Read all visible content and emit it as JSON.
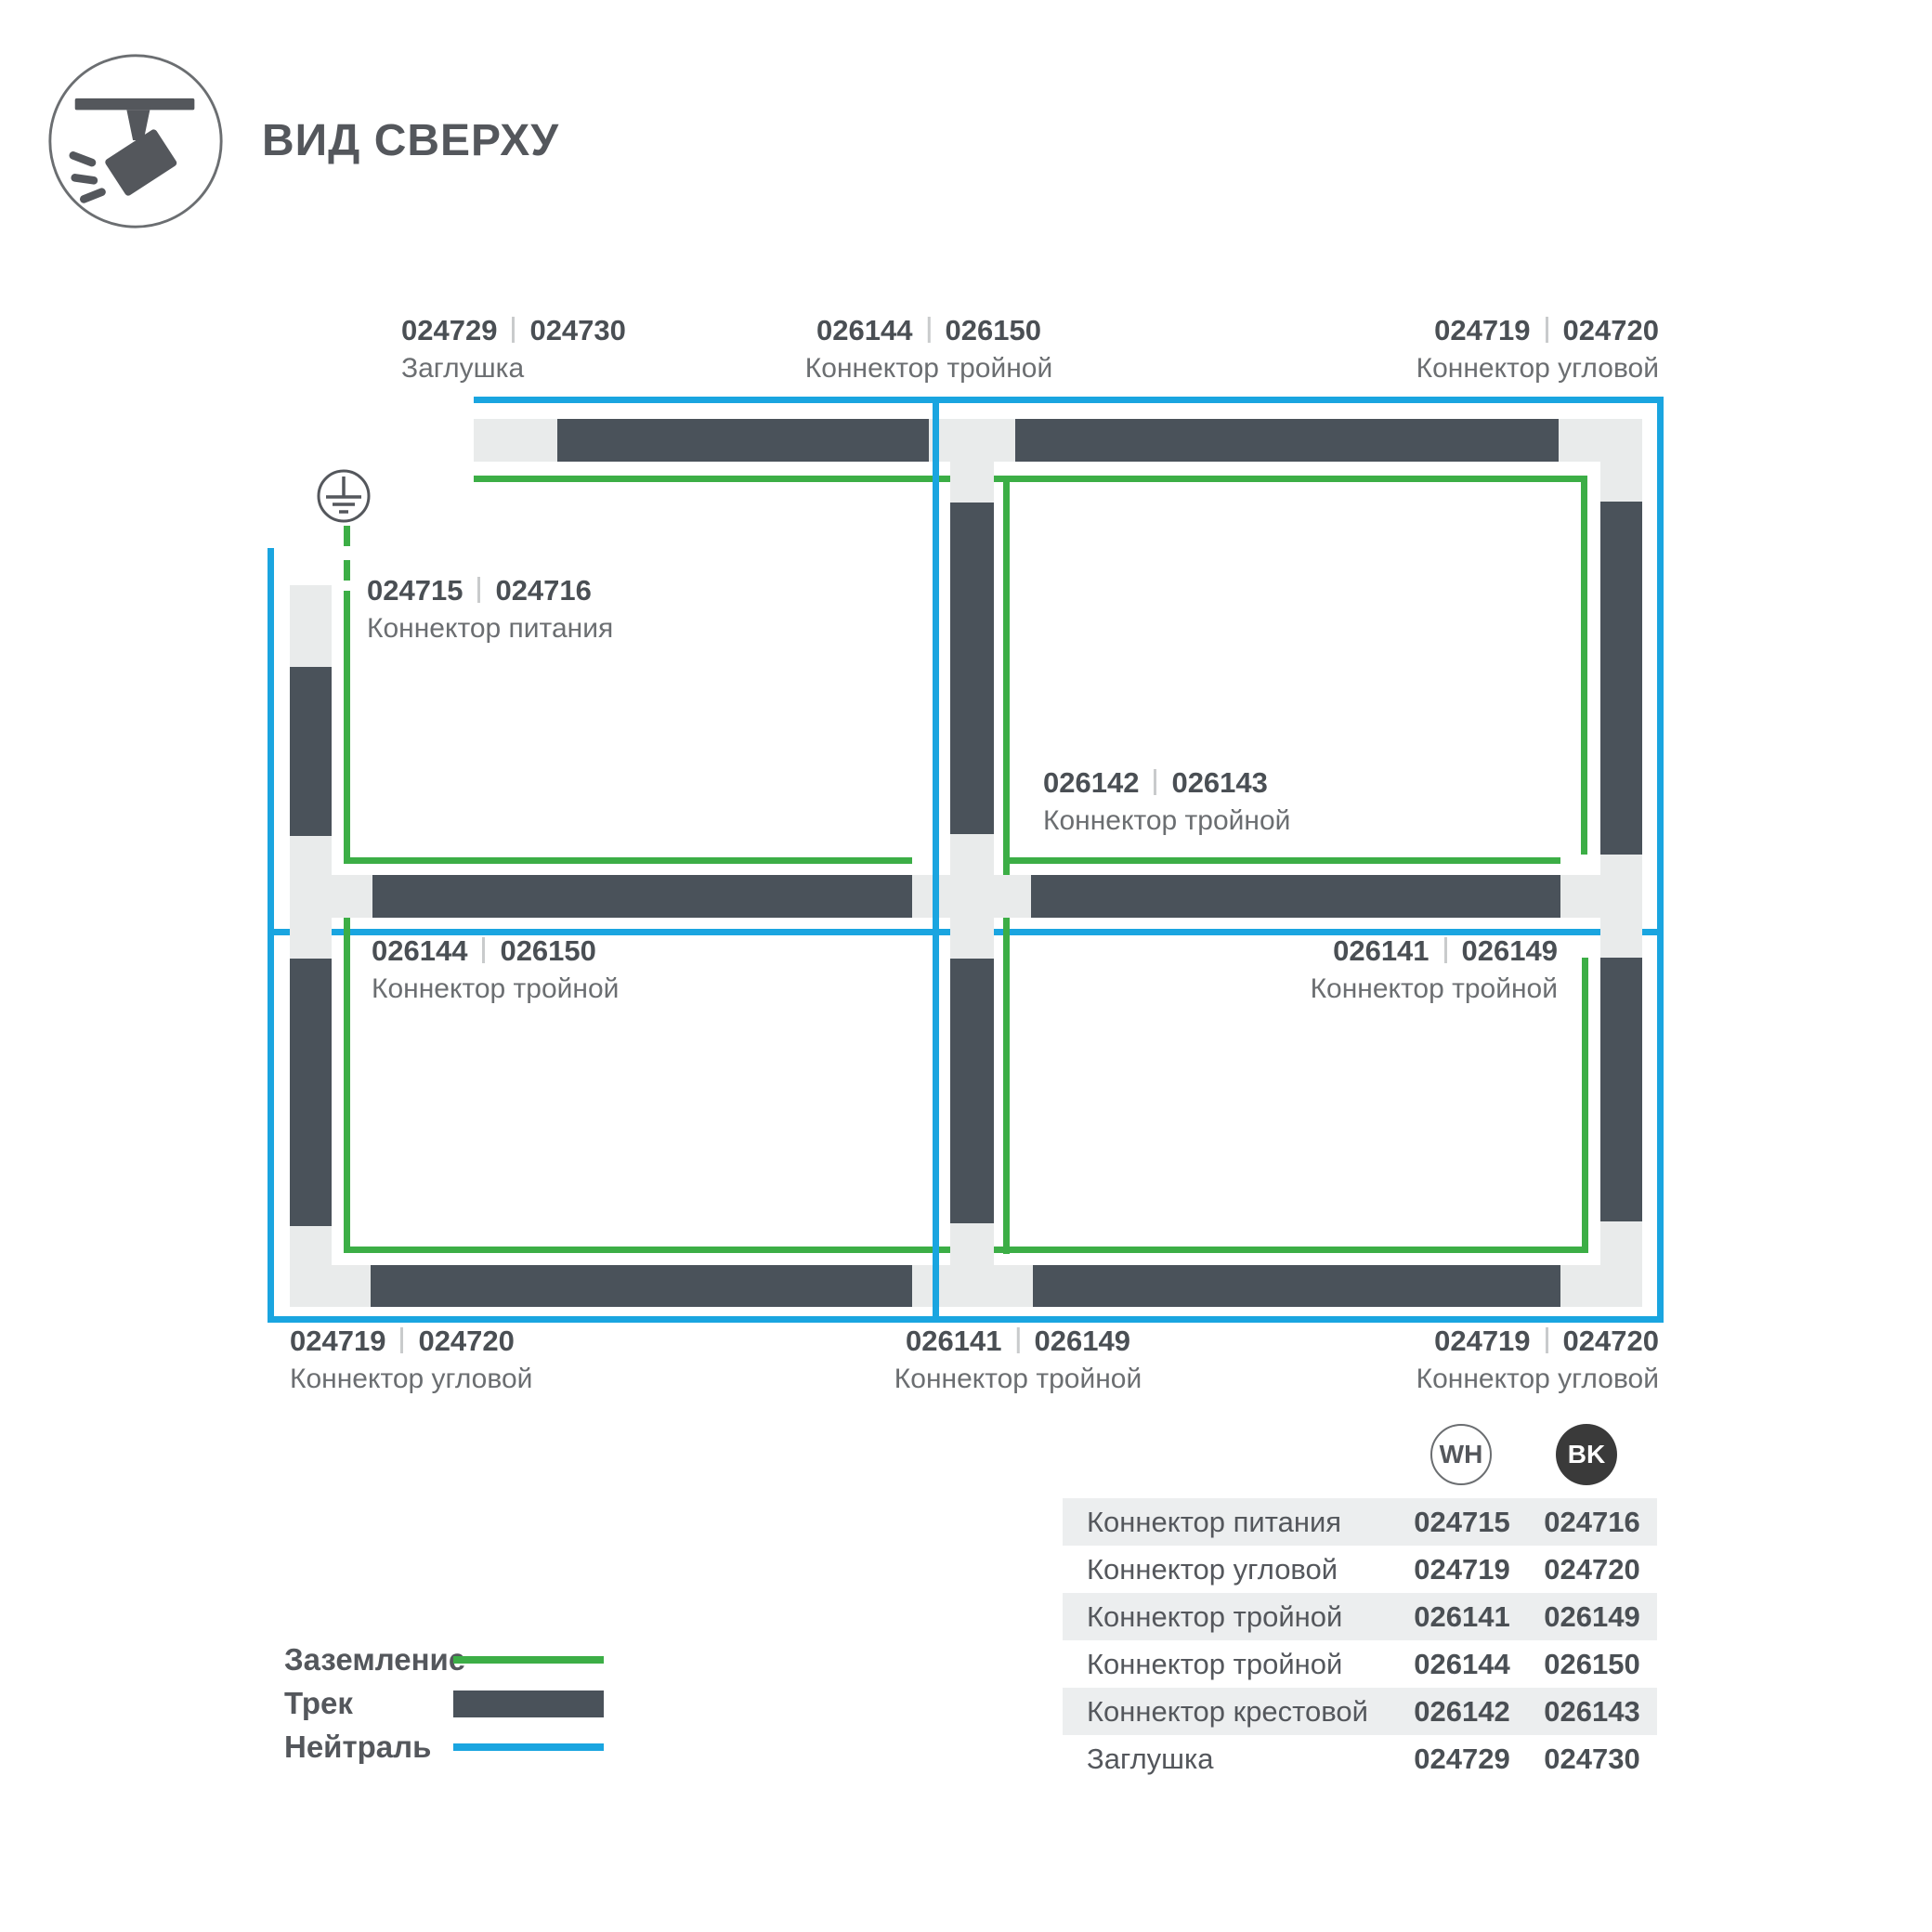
{
  "header": {
    "title": "ВИД СВЕРХУ"
  },
  "colors": {
    "track": "#4A525A",
    "connector": "#E9EBEB",
    "ground_green": "#3CAE46",
    "neutral_blue": "#1AA5E0",
    "badge_black": "#3A3A3A"
  },
  "labels": {
    "cap_top": {
      "wh": "024729",
      "bk": "024730",
      "name": "Заглушка"
    },
    "tee_top": {
      "wh": "026144",
      "bk": "026150",
      "name": "Коннектор тройной"
    },
    "corner_tr": {
      "wh": "024719",
      "bk": "024720",
      "name": "Коннектор угловой"
    },
    "power": {
      "wh": "024715",
      "bk": "024716",
      "name": "Коннектор питания"
    },
    "cross": {
      "wh": "026142",
      "bk": "026143",
      "name": "Коннектор тройной"
    },
    "tee_mid_left": {
      "wh": "026144",
      "bk": "026150",
      "name": "Коннектор тройной"
    },
    "tee_mid_right": {
      "wh": "026141",
      "bk": "026149",
      "name": "Коннектор тройной"
    },
    "corner_bl": {
      "wh": "024719",
      "bk": "024720",
      "name": "Коннектор угловой"
    },
    "tee_bottom": {
      "wh": "026141",
      "bk": "026149",
      "name": "Коннектор тройной"
    },
    "corner_br": {
      "wh": "024719",
      "bk": "024720",
      "name": "Коннектор угловой"
    }
  },
  "legend": {
    "ground": "Заземление",
    "track": "Трек",
    "neutral": "Нейтраль"
  },
  "table": {
    "col_wh": "WH",
    "col_bk": "BK",
    "rows": [
      {
        "name": "Коннектор питания",
        "wh": "024715",
        "bk": "024716"
      },
      {
        "name": "Коннектор угловой",
        "wh": "024719",
        "bk": "024720"
      },
      {
        "name": "Коннектор тройной",
        "wh": "026141",
        "bk": "026149"
      },
      {
        "name": "Коннектор тройной",
        "wh": "026144",
        "bk": "026150"
      },
      {
        "name": "Коннектор крестовой",
        "wh": "026142",
        "bk": "026143"
      },
      {
        "name": "Заглушка",
        "wh": "024729",
        "bk": "024730"
      }
    ]
  }
}
